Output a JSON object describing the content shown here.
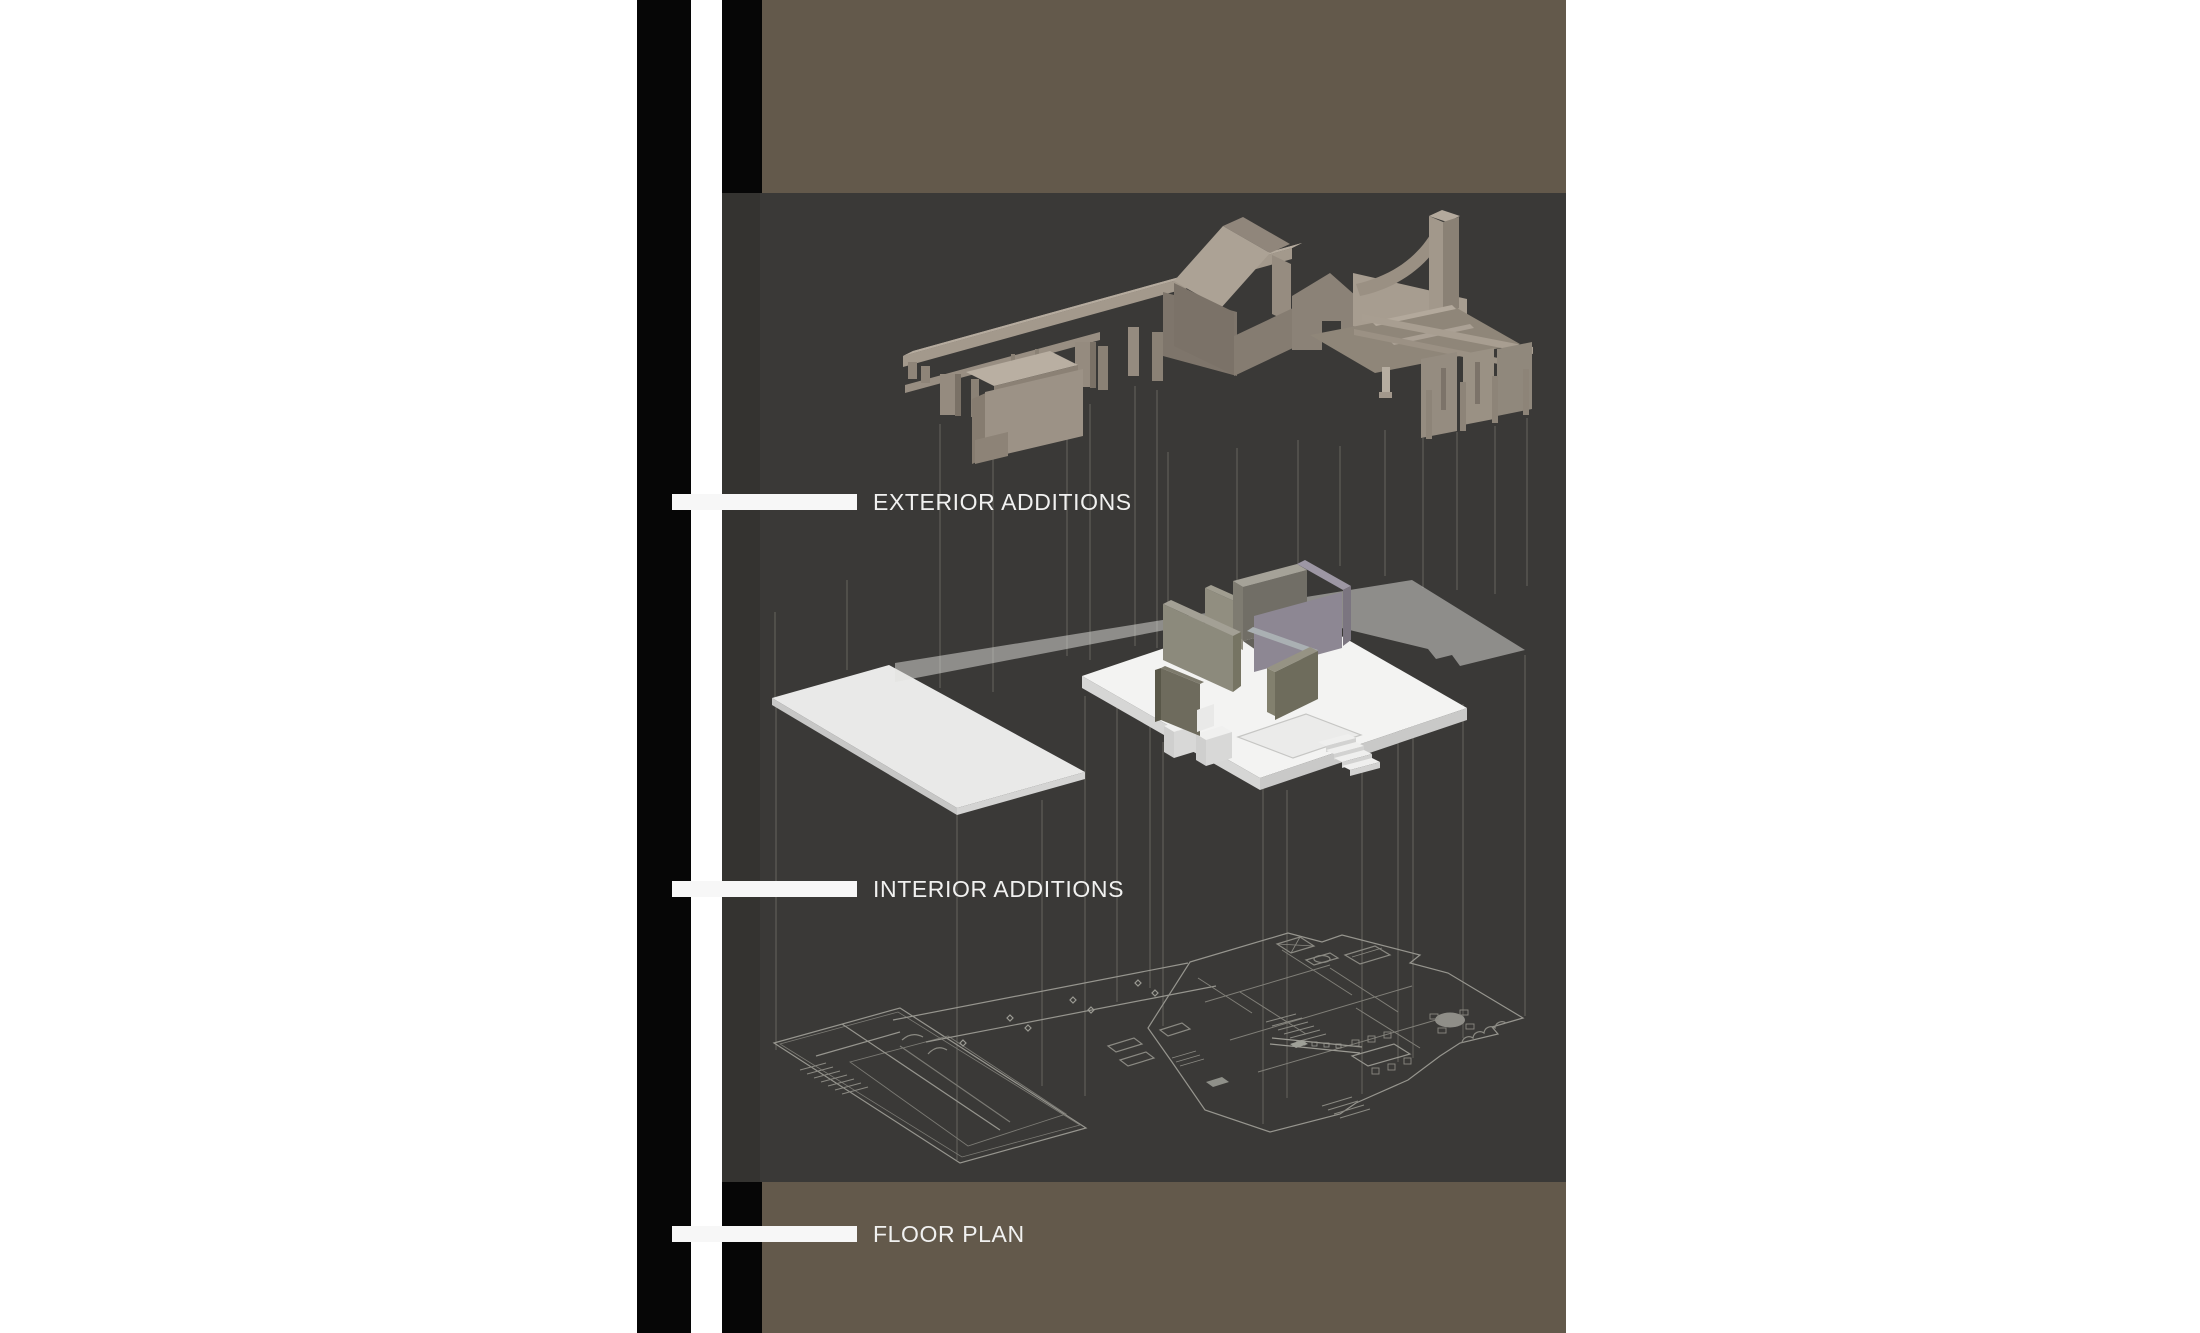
{
  "annotations": {
    "exterior": {
      "label": "EXTERIOR ADDITIONS"
    },
    "interior": {
      "label": "INTERIOR ADDITIONS"
    },
    "floor_plan": {
      "label": "FLOOR PLAN"
    }
  },
  "colors": {
    "page_background": "#ffffff",
    "sidebar_bar": "#060606",
    "band_brown": "#63594b",
    "panel_dark": "#3a3937",
    "panel_dark_edge": "#343330",
    "tick_white": "#f7f7f7",
    "label_text": "#f1f1f0",
    "model_light": "#b5ab9e",
    "model_mid": "#9c9286",
    "model_shadow": "#7b7268",
    "plate_white": "#f3f3f2",
    "wall_olive": "#8c8a7c",
    "wall_purple": "#8d8793",
    "plan_line": "#96958e",
    "projection_line": "#5c5b56"
  }
}
